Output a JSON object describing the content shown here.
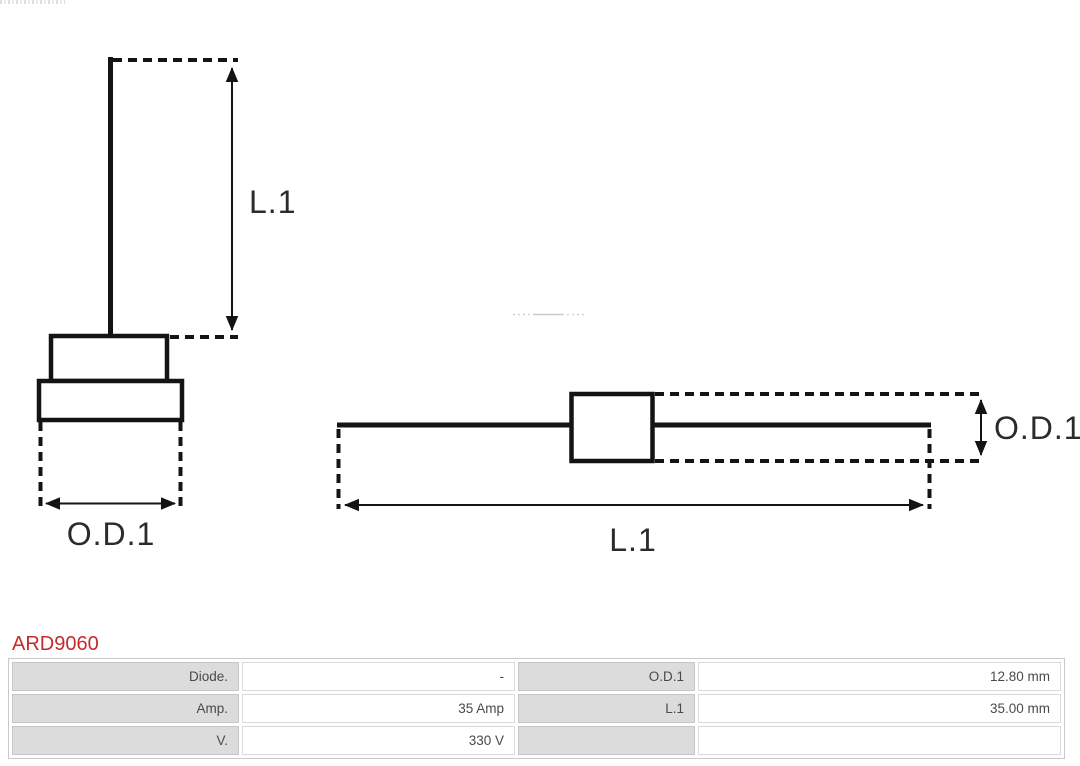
{
  "product": {
    "code": "ARD9060",
    "code_color": "#c52b2b"
  },
  "diagrams": {
    "stroke_color": "#141414",
    "side_view": {
      "length_label": "L.1",
      "diameter_label": "O.D.1"
    },
    "axial_view": {
      "length_label": "L.1",
      "diameter_label": "O.D.1"
    }
  },
  "spec_table": {
    "label_cell_bg": "#dcdcdc",
    "border_color": "#c9c9c9",
    "text_color": "#4a4a4a",
    "rows": [
      {
        "label_left": "Diode.",
        "value_left": "-",
        "label_right": "O.D.1",
        "value_right": "12.80 mm"
      },
      {
        "label_left": "Amp.",
        "value_left": "35 Amp",
        "label_right": "L.1",
        "value_right": "35.00 mm"
      },
      {
        "label_left": "V.",
        "value_left": "330 V",
        "label_right": "",
        "value_right": ""
      }
    ]
  }
}
